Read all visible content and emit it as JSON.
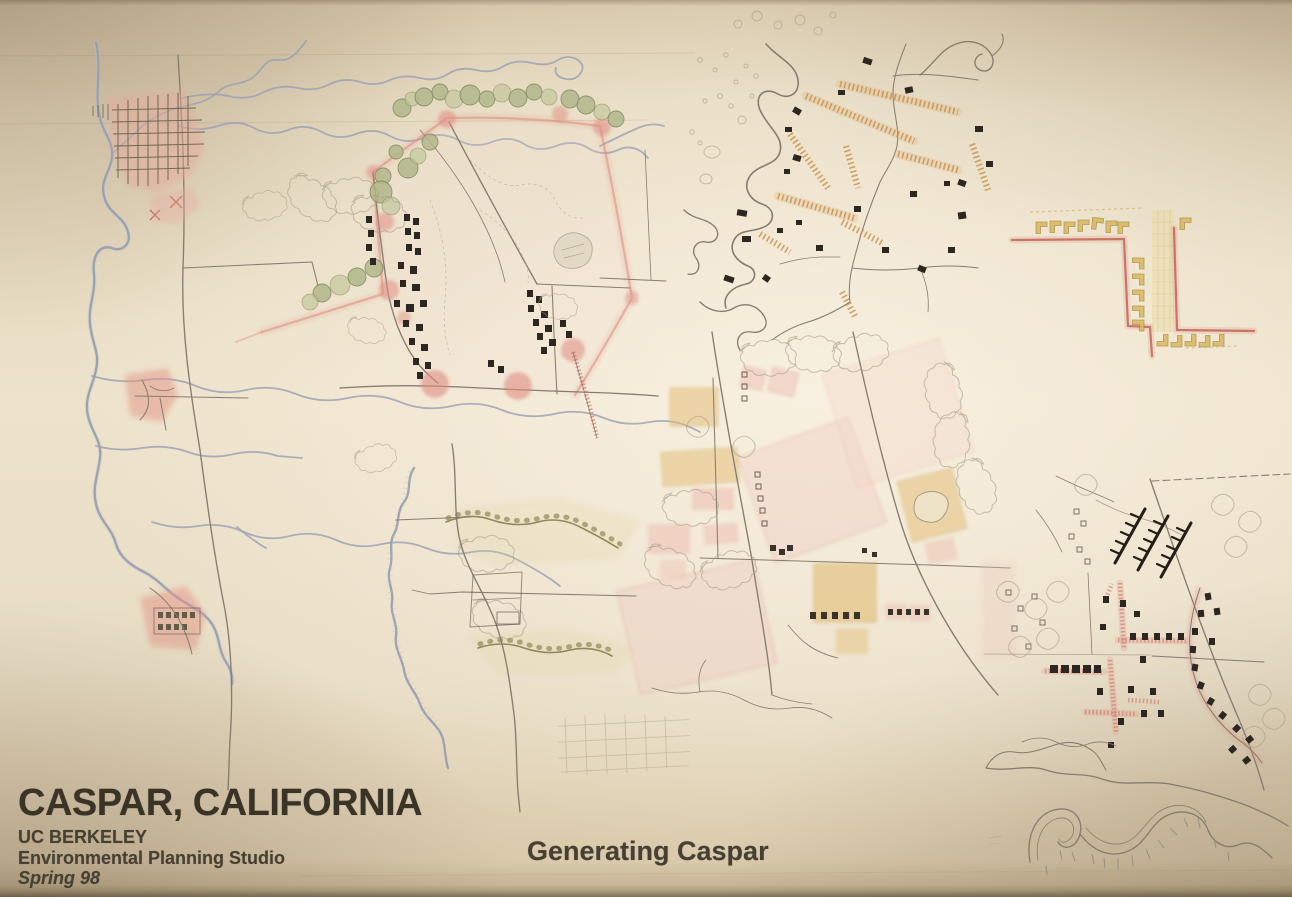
{
  "poster": {
    "title": "CASPAR, CALIFORNIA",
    "institution": "UC BERKELEY",
    "studio_line": "Environmental Planning Studio",
    "term": "Spring 98",
    "caption": "Generating Caspar"
  },
  "palette": {
    "paper": "#e8ddc6",
    "paper_highlight": "#f4ecda",
    "paper_shadow": "#b6a285",
    "ink_text": "#3c3628",
    "road_gray": "#877d6f",
    "water_blue": "#98a0b4",
    "settlement_pink": "#e08d83",
    "wash_pink": "#f0d3c8",
    "wash_ochre": "#e2bd76",
    "tree_green": "#b2b88b",
    "tree_outline": "#7e855e",
    "hedgerow_orange": "#c6883f",
    "street_red": "#c25d50",
    "building_black": "#2c2720",
    "pencil": "#b2a48b"
  },
  "figures": [
    {
      "id": "coastal-strip-map",
      "kind": "regional coastline map with gridded town and creeks"
    },
    {
      "id": "headlands-site-plan",
      "kind": "site plan edged with trees, pink nodes and building rows"
    },
    {
      "id": "hedgerow-fields-sketch",
      "kind": "field sketch with orange hedgerows and scattered buildings"
    },
    {
      "id": "crossroads-block-plan",
      "kind": "stepped red street diagram with yellow lot rows"
    },
    {
      "id": "central-fields-plan",
      "kind": "village plan with pink and ochre tinted fields"
    },
    {
      "id": "creek-vegetation-plan",
      "kind": "creek and vegetation edge study"
    },
    {
      "id": "village-center-plan",
      "kind": "dense village center plan with building combs and red streets"
    },
    {
      "id": "river-contours-sketch",
      "kind": "river meander contour sketch with hachures"
    }
  ]
}
